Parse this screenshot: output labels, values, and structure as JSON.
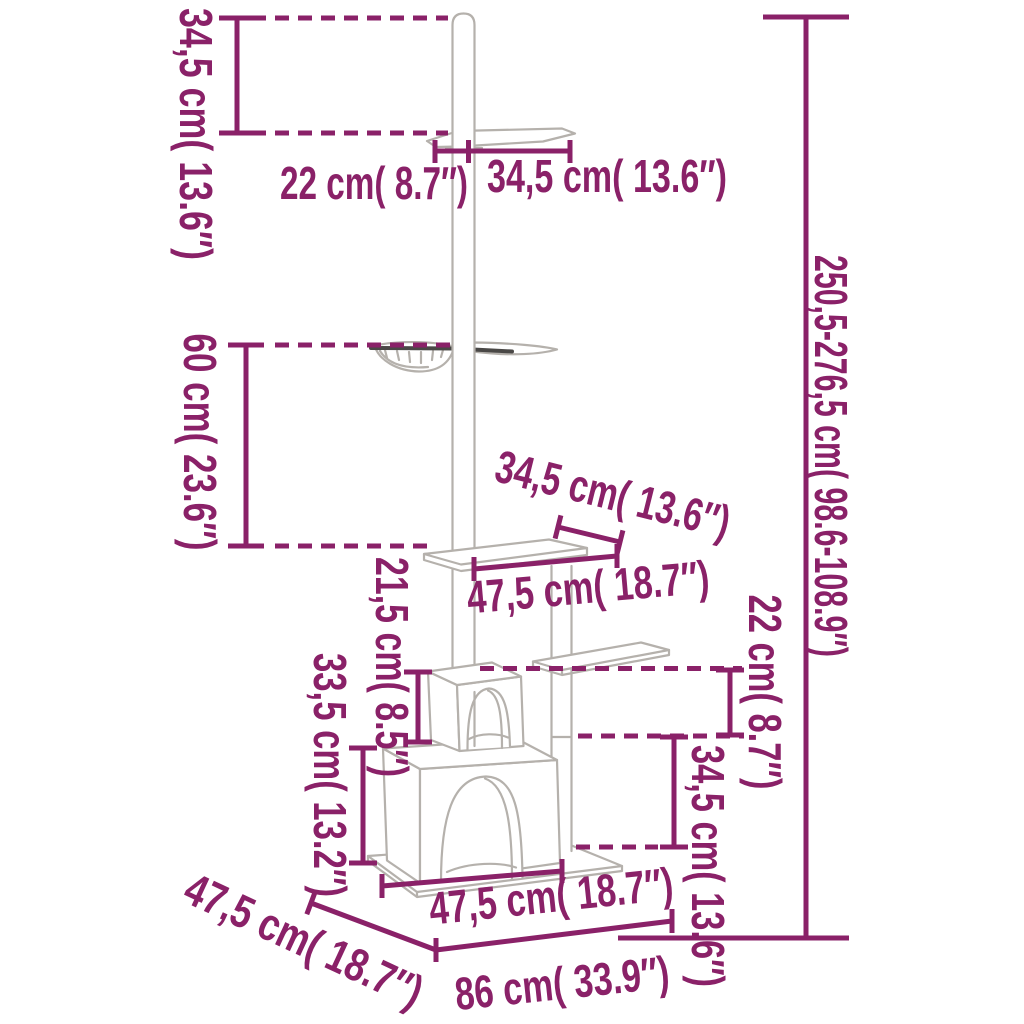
{
  "diagram": {
    "title": "floor-to-ceiling cat tree dimension diagram",
    "accent_color": "#8A2168",
    "sketch_color": "#B5B1AC"
  },
  "labels": {
    "upper_section_height": "34,5 cm( 13.6″)",
    "top_platform_left_width": "22 cm( 8.7″)",
    "top_platform_right_width": "34,5 cm( 13.6″)",
    "total_height_range": "250,5-276,5 cm( 98.6-108.9″)",
    "hammock_drop_height": "60 cm( 23.6″)",
    "middle_platform_depth": "34,5 cm( 13.6″)",
    "middle_platform_width": "47,5 cm( 18.7″)",
    "upper_house_height": "21,5 cm( 8.5″)",
    "side_platform_drop": "22 cm( 8.7″)",
    "lower_house_height": "33,5 cm( 13.2″)",
    "side_platform_height": "34,5 cm( 13.6″)",
    "base_depth": "47,5 cm( 18.7″)",
    "house_front_width": "47,5 cm( 18.7″)",
    "base_width": "86 cm( 33.9″)"
  }
}
